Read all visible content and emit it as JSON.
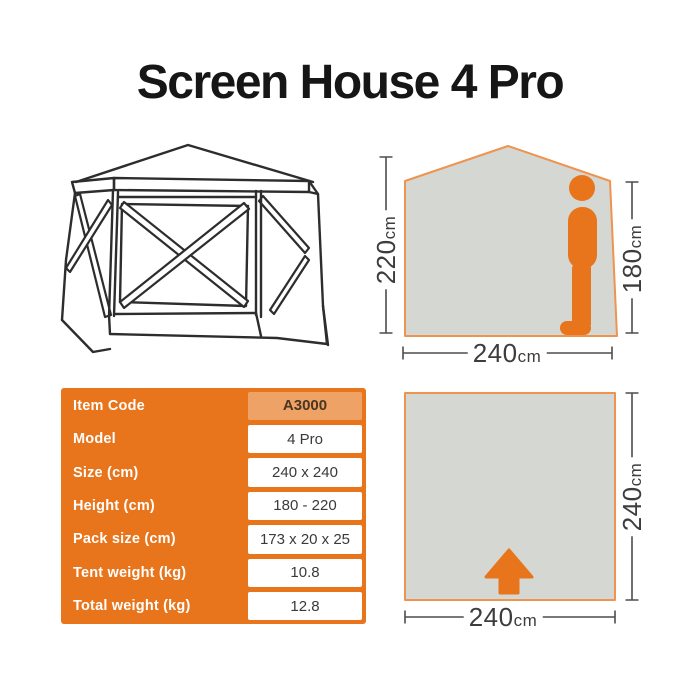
{
  "title": "Screen House 4 Pro",
  "colors": {
    "orange": "#E8751C",
    "orange_light": "#EEA266",
    "gray_fill": "#D5D7D3",
    "stroke_orange": "#EE9350",
    "ink": "#2D2D2D",
    "dim_line": "#4D4D4D",
    "dim_text": "#3D3D3D",
    "value_text": "#3A3A3A",
    "code_text": "#4A3621",
    "title_ink": "#161616"
  },
  "icons": {
    "person": "person-silhouette",
    "arrow": "arrow-up"
  },
  "profile_diagram": {
    "max_height": {
      "value": "220",
      "unit": "cm"
    },
    "person_height": {
      "value": "180",
      "unit": "cm"
    },
    "width": {
      "value": "240",
      "unit": "cm"
    }
  },
  "footprint_diagram": {
    "depth": {
      "value": "240",
      "unit": "cm"
    },
    "width": {
      "value": "240",
      "unit": "cm"
    }
  },
  "spec_table": {
    "rows": [
      {
        "label": "Item Code",
        "value": "A3000",
        "highlight": true
      },
      {
        "label": "Model",
        "value": "4 Pro",
        "highlight": false
      },
      {
        "label": "Size (cm)",
        "value": "240 x 240",
        "highlight": false
      },
      {
        "label": "Height (cm)",
        "value": "180 - 220",
        "highlight": false
      },
      {
        "label": "Pack size (cm)",
        "value": "173 x 20 x 25",
        "highlight": false
      },
      {
        "label": "Tent weight (kg)",
        "value": "10.8",
        "highlight": false
      },
      {
        "label": "Total weight (kg)",
        "value": "12.8",
        "highlight": false
      }
    ]
  }
}
